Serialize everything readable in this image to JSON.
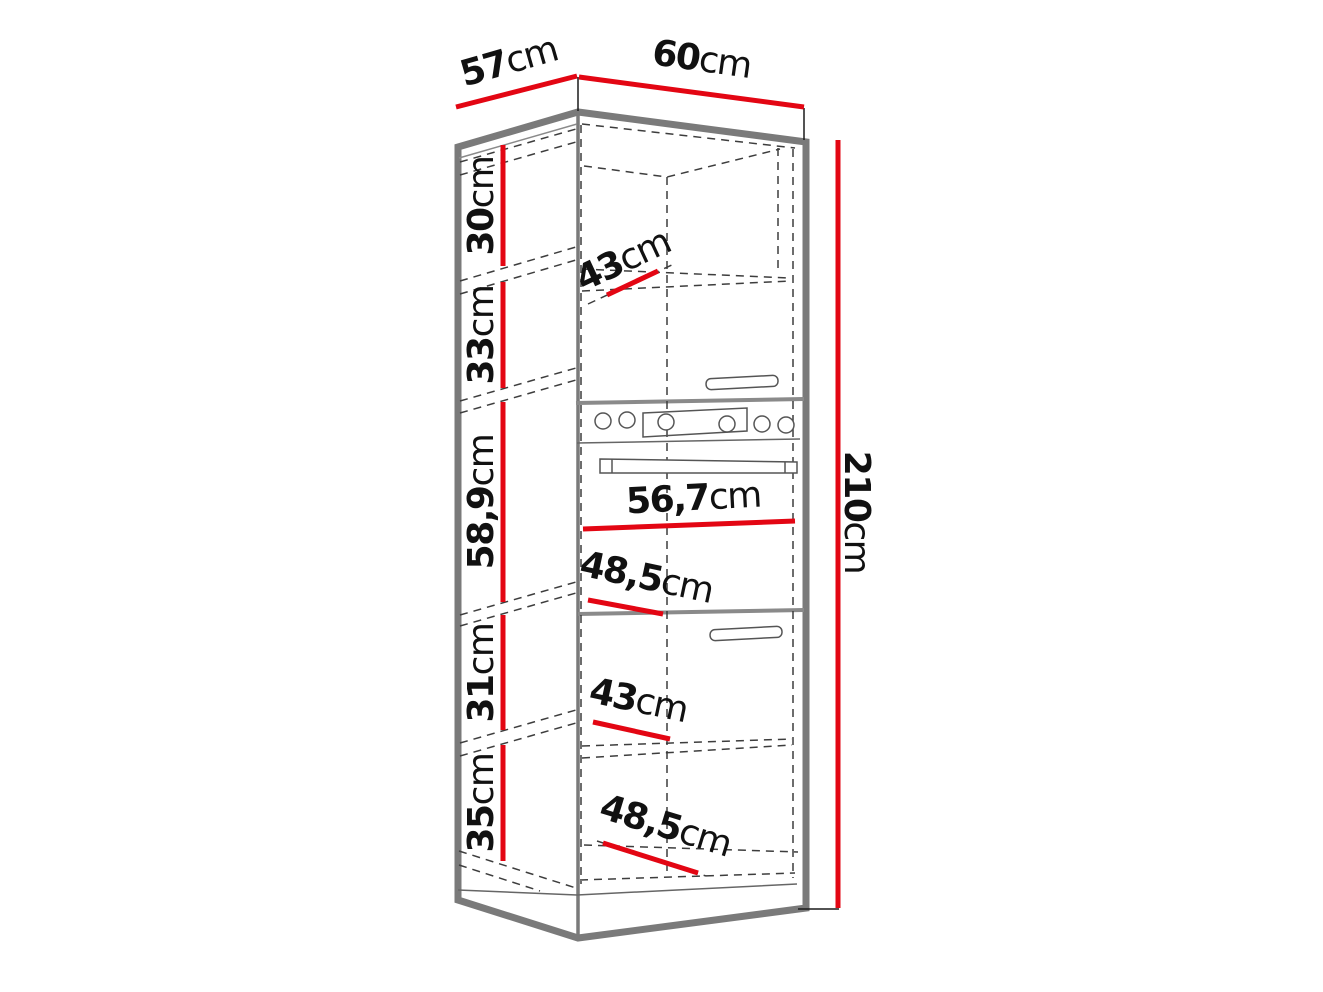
{
  "diagram": {
    "type": "furniture-dimension-drawing",
    "subject": "tall-kitchen-oven-cabinet",
    "dimensions": {
      "depth": {
        "num": "57",
        "unit": "cm"
      },
      "width": {
        "num": "60",
        "unit": "cm"
      },
      "height": {
        "num": "210",
        "unit": "cm"
      },
      "section_heights": [
        {
          "name": "top-open-shelf",
          "num": "30",
          "unit": "cm"
        },
        {
          "name": "upper-door",
          "num": "33",
          "unit": "cm"
        },
        {
          "name": "oven-compartment",
          "num": "58,9",
          "unit": "cm"
        },
        {
          "name": "lower-door",
          "num": "31",
          "unit": "cm"
        },
        {
          "name": "bottom-open-shelf",
          "num": "35",
          "unit": "cm"
        }
      ],
      "interior_widths": [
        {
          "name": "top-shelf-width",
          "num": "43",
          "unit": "cm"
        },
        {
          "name": "oven-opening-width",
          "num": "56,7",
          "unit": "cm"
        },
        {
          "name": "oven-shelf-depth",
          "num": "48,5",
          "unit": "cm"
        },
        {
          "name": "lower-shelf-width",
          "num": "43",
          "unit": "cm"
        },
        {
          "name": "bottom-shelf-depth",
          "num": "48,5",
          "unit": "cm"
        }
      ]
    },
    "colors": {
      "dimension_red": "#e30613",
      "cabinet_outline_gray": "#7a7a7a",
      "hidden_line_dark": "#3d3d3d",
      "text_black": "#111111",
      "background": "#ffffff"
    }
  }
}
